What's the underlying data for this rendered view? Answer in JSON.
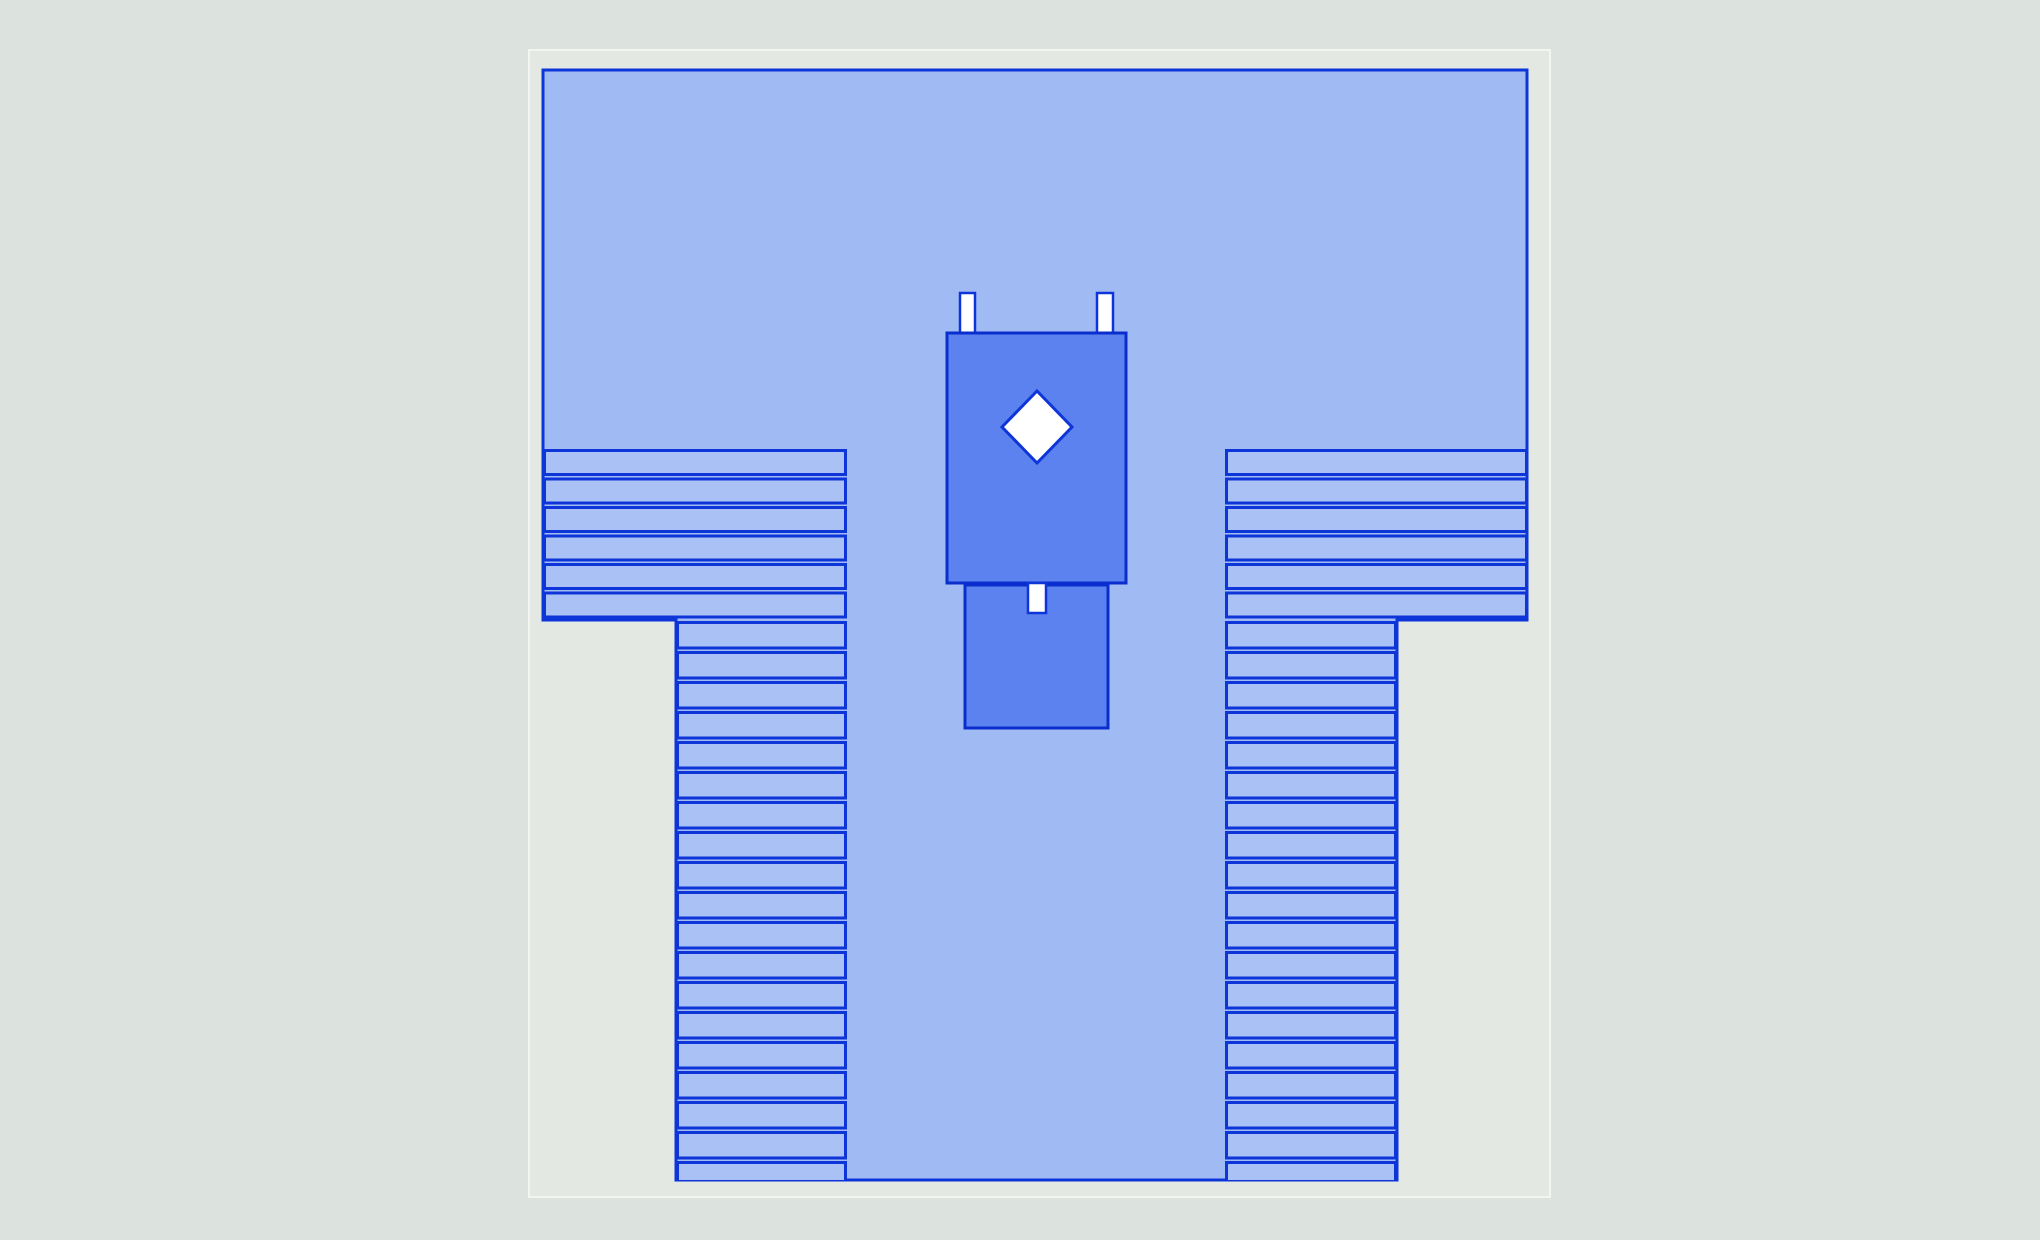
{
  "page": {
    "width": 2040,
    "height": 1240,
    "background": "#dce2dd"
  },
  "diagram": {
    "canvas": {
      "x": 529,
      "y": 50,
      "w": 1021,
      "h": 1147,
      "fill": "#e3e8e3",
      "edge": "#f2f5f2",
      "edge_width": 2
    },
    "palette": {
      "shape_fill": "#a0bbf3",
      "stripe_fill": "#a9c1f5",
      "line": "#0e35d8",
      "vehicle_fill": "#5b82ee",
      "vehicle_line": "#0a2ecd",
      "white": "#ffffff"
    },
    "outline": {
      "id": "main-shape-outline",
      "points": [
        [
          543,
          70
        ],
        [
          1527,
          70
        ],
        [
          1527,
          620
        ],
        [
          1397,
          620
        ],
        [
          1397,
          1180
        ],
        [
          676,
          1180
        ],
        [
          676,
          620
        ],
        [
          543,
          620
        ]
      ],
      "stroke_width": 3
    },
    "stripe_stroke_width": 3,
    "stripe_blocks": [
      {
        "id": "stripe-block-upper-left",
        "x": 543,
        "y": 449,
        "w": 304,
        "h": 171,
        "pitch": 28.5,
        "count": 6
      },
      {
        "id": "stripe-block-upper-right",
        "x": 1225,
        "y": 449,
        "w": 303,
        "h": 171,
        "pitch": 28.5,
        "count": 6
      },
      {
        "id": "stripe-block-lower-left",
        "x": 676,
        "y": 621,
        "w": 171,
        "h": 559,
        "pitch": 30,
        "count": 19
      },
      {
        "id": "stripe-block-lower-right",
        "x": 1225,
        "y": 621,
        "w": 172,
        "h": 559,
        "pitch": 30,
        "count": 19
      }
    ],
    "vehicle": {
      "tabs": [
        {
          "id": "vehicle-tab-left",
          "x": 960,
          "y": 293,
          "w": 15,
          "h": 46
        },
        {
          "id": "vehicle-tab-right",
          "x": 1097,
          "y": 293,
          "w": 16,
          "h": 46
        }
      ],
      "tab_stroke_width": 2.5,
      "trailer": {
        "id": "vehicle-trailer",
        "x": 965,
        "y": 585,
        "w": 143,
        "h": 143,
        "stroke_width": 3
      },
      "body": {
        "id": "vehicle-body",
        "x": 947,
        "y": 333,
        "w": 179,
        "h": 250,
        "stroke_width": 3
      },
      "hitch": {
        "id": "vehicle-hitch",
        "x": 1028,
        "y": 583,
        "w": 18,
        "h": 30,
        "stroke_width": 2.5
      },
      "diamond": {
        "id": "vehicle-diamond-marker",
        "cx": 1037,
        "cy": 427,
        "rx": 35,
        "ry": 36,
        "stroke_width": 3
      }
    }
  }
}
